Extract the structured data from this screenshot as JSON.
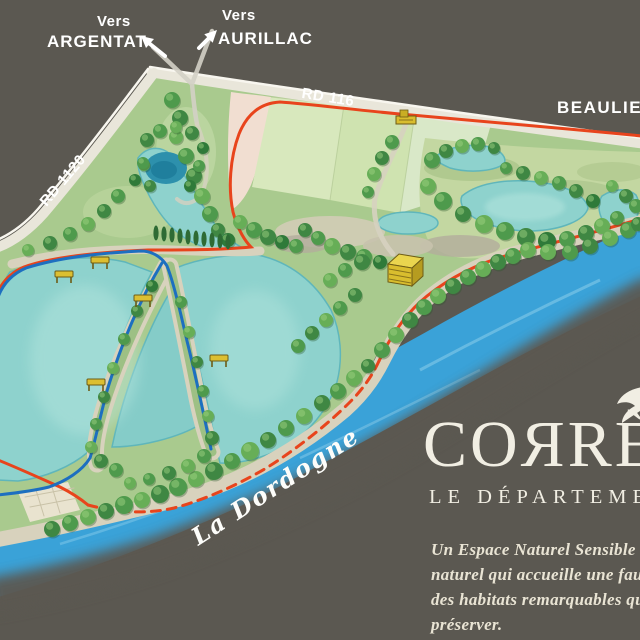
{
  "directions": {
    "argentat": {
      "prefix": "Vers",
      "name": "ARGENTAT"
    },
    "aurillac": {
      "prefix": "Vers",
      "name": "AURILLAC"
    }
  },
  "road_labels": {
    "rd116": "RD 116",
    "rd1120": "RD 1120"
  },
  "destination_label": "BEAULIEU",
  "river_label": "La Dordogne",
  "logo": {
    "title": "COЯRÈZE",
    "subtitle": "LE DÉPARTEMENT"
  },
  "description_lines": [
    "Un Espace Naturel Sensible (E",
    "naturel qui accueille une fau",
    "des habitats remarquables qu",
    "préserver."
  ],
  "map_colors": {
    "background": "#5b5851",
    "river_blue": "#3aa2d8",
    "lake_turquoise": "#8ed2cd",
    "trail_red": "#e8441c",
    "trail_blue": "#1d6fc0",
    "road": "#e9e6da",
    "label_text": "#ffffff",
    "logo_text": "#f1eee3"
  }
}
